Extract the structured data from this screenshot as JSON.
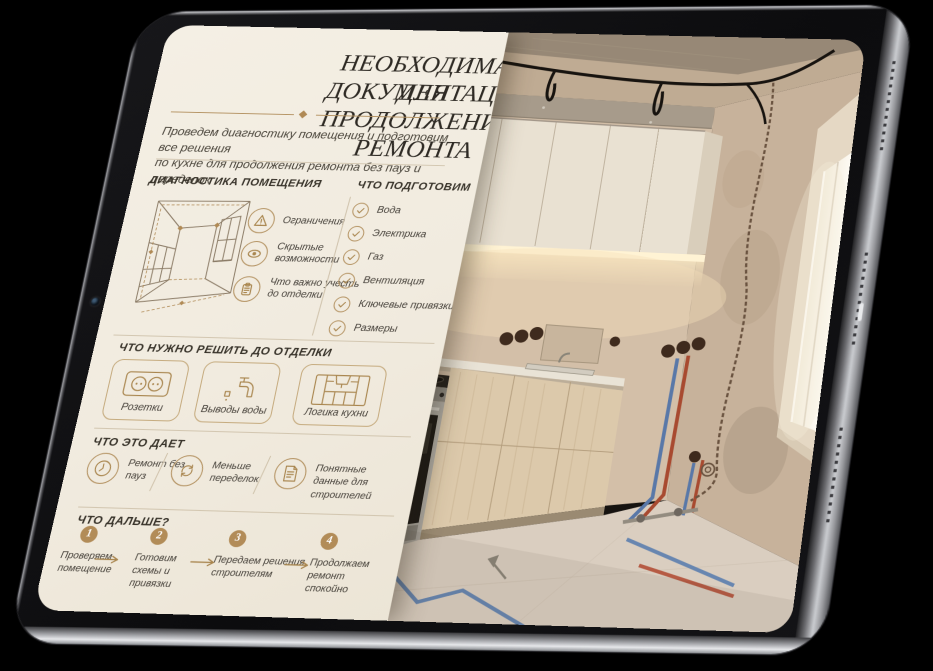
{
  "colors": {
    "background": "#000000",
    "poster_cream": "#f1ebdf",
    "accent_gold": "#b08a55",
    "title_text": "#2e2a24",
    "body_text": "#46413a",
    "frame_silver": "#caccd0",
    "cabinet_glow": "#ffeec6"
  },
  "poster": {
    "title_lines": [
      "НЕОБХОДИМАЯ ДОКУМЕНТАЦИЯ",
      "ДЛЯ ПРОДОЛЖЕНИЯ РЕМОНТА"
    ],
    "subtitle_lines": [
      "Проведем диагностику помещения и подготовим все решения",
      "по кухне для продолжения ремонта без пауз и переделок"
    ],
    "diagnostics": {
      "heading": "ДИАГНОСТИКА ПОМЕЩЕНИЯ",
      "items": [
        {
          "icon": "warning-triangle-icon",
          "label": "Ограничения"
        },
        {
          "icon": "eye-icon",
          "label": "Скрытые возможности"
        },
        {
          "icon": "clipboard-icon",
          "label": "Что важно учесть до отделки"
        }
      ]
    },
    "prepare": {
      "heading": "ЧТО ПОДГОТОВИМ",
      "items": [
        "Вода",
        "Электрика",
        "Газ",
        "Вентиляция",
        "Ключевые привязки",
        "Размеры"
      ]
    },
    "decide": {
      "heading": "ЧТО НУЖНО РЕШИТЬ ДО ОТДЕЛКИ",
      "cards": [
        {
          "icon": "power-socket-icon",
          "label": "Розетки"
        },
        {
          "icon": "water-tap-icon",
          "label": "Выводы воды"
        },
        {
          "icon": "kitchen-elevation-icon",
          "label": "Логика кухни"
        }
      ]
    },
    "benefits": {
      "heading": "ЧТО ЭТО ДАЕТ",
      "items": [
        {
          "icon": "clock-icon",
          "label": "Ремонт без пауз"
        },
        {
          "icon": "refresh-icon",
          "label": "Меньше переделок"
        },
        {
          "icon": "document-icon",
          "label": "Понятные данные для строителей"
        }
      ]
    },
    "next": {
      "heading": "ЧТО ДАЛЬШЕ?",
      "steps": [
        {
          "num": "1",
          "label": "Проверяем помещение"
        },
        {
          "num": "2",
          "label": "Готовим схемы и привязки"
        },
        {
          "num": "3",
          "label": "Передаем решения строителям"
        },
        {
          "num": "4",
          "label": "Продолжаем ремонт спокойно"
        }
      ]
    }
  }
}
